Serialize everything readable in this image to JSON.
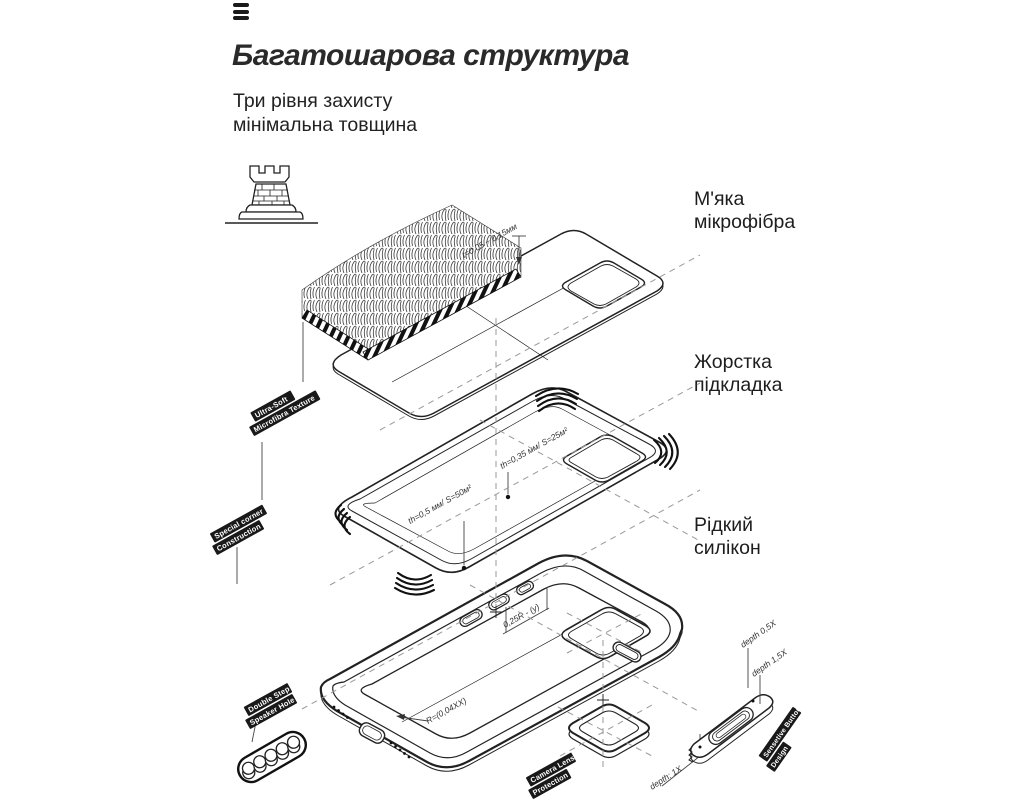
{
  "header": {
    "menu_icon": "hamburger-icon",
    "title": "Багатошарова структура",
    "subtitle_line1": "Три рівня захисту",
    "subtitle_line2": "мінімальна товщина"
  },
  "layer_labels": [
    {
      "id": "microfiber",
      "line1": "М'яка",
      "line2": "мікрофібра"
    },
    {
      "id": "lining",
      "line1": "Жорстка",
      "line2": "підкладка"
    },
    {
      "id": "silicone",
      "line1": "Рідкий",
      "line2": "силікон"
    }
  ],
  "diagram": {
    "icon": "castle-tower-icon",
    "annotations": {
      "sheet_thickness": "t=0,05 ÷ 0,15мм",
      "lining_top": "th=0,35 мм/ S=25м²",
      "lining_bottom": "th=0,5 мм/ S=50м²",
      "slot_dim": "0,25R - (у)",
      "corner_radius": "R=(0,04XX)",
      "camera_depth": "depth: 1X",
      "button_depth_a": "depth 0,5X",
      "button_depth_b": "depth 1,5X"
    },
    "tags": {
      "fur": [
        "Ultra-Soft",
        "Microfibra Texture"
      ],
      "corner": [
        "Special corner",
        "Construction"
      ],
      "speaker": [
        "Double Step",
        "Speaker Hole"
      ],
      "camera": [
        "Camera Lens",
        "Protection"
      ],
      "button": [
        "Sensetive Button",
        "Design"
      ]
    }
  }
}
